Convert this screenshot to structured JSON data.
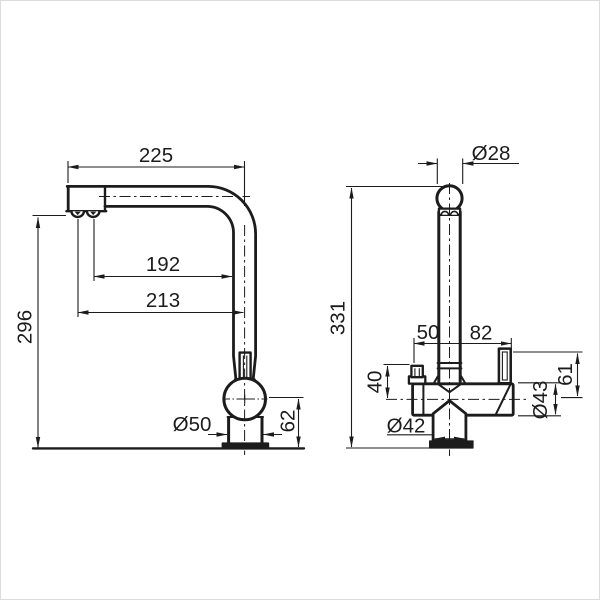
{
  "drawing": {
    "background": "#ffffff",
    "line_color": "#1c1c1c",
    "views": {
      "side": {
        "name": "side view",
        "dims": {
          "spout_reach": "225",
          "aerator_to_body": "192",
          "aerator_to_axis": "213",
          "spout_height": "296",
          "base_diameter": "Ø50",
          "ball_joint_height": "62"
        }
      },
      "front": {
        "name": "front view",
        "dims": {
          "spout_tube_diameter": "Ø28",
          "overall_height": "331",
          "axis_to_left_handle": "50",
          "axis_to_right_handle": "82",
          "left_handle_height": "40",
          "right_handle_height": "61",
          "body_diameter": "Ø43",
          "outlet_diameter": "Ø42"
        }
      }
    }
  }
}
